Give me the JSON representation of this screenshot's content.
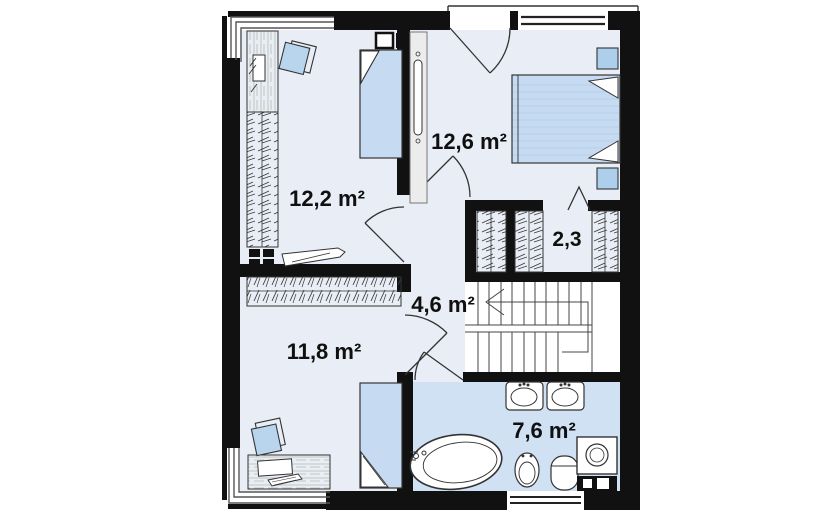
{
  "plan": {
    "type": "floor-plan",
    "storey": "attic",
    "rooms": [
      {
        "id": "bedroom-top-left",
        "area_label": "12,2 m²"
      },
      {
        "id": "bedroom-top-right",
        "area_label": "12,6 m²"
      },
      {
        "id": "walk-in-closet",
        "area_label": "2,3"
      },
      {
        "id": "hallway",
        "area_label": "4,6 m²"
      },
      {
        "id": "bedroom-bottom-left",
        "area_label": "11,8 m²"
      },
      {
        "id": "bathroom",
        "area_label": "7,6 m²"
      }
    ],
    "fixtures": [
      "bathtub",
      "sink",
      "sink",
      "toilet",
      "bidet",
      "washing-machine"
    ],
    "furniture": [
      "single-bed",
      "double-bed",
      "nightstand",
      "wardrobe",
      "desk",
      "chair",
      "dresser",
      "radiator",
      "stairs"
    ],
    "colors": {
      "wall": "#111111",
      "floor": "#e9eef6",
      "bathroom_floor": "#cfe1f3",
      "bed_fill": "#c6dbf1",
      "bed_stripe": "#b4cfe9",
      "chair_fill": "#b9d5ee",
      "nightstand_fill": "#aecfeb",
      "line": "#333333"
    }
  }
}
